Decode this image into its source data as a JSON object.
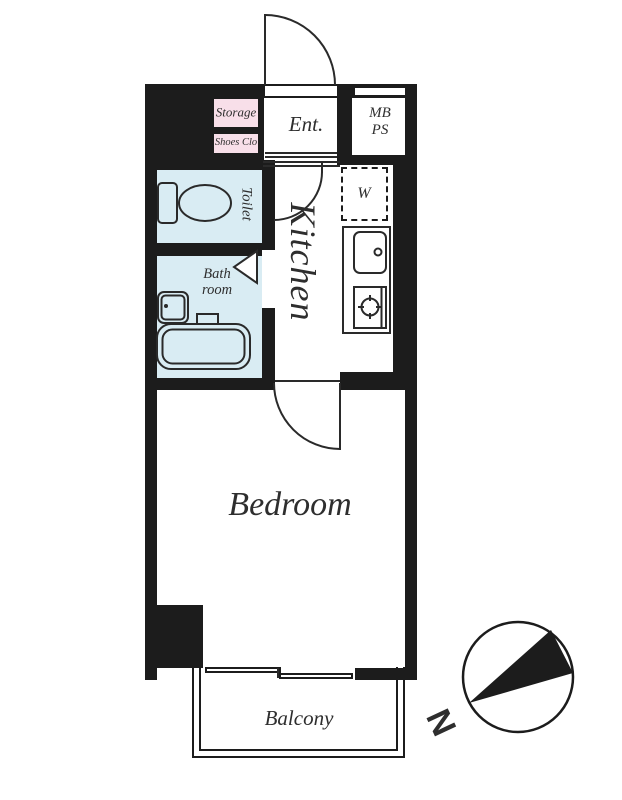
{
  "plan": {
    "type": "apartment-floor-plan",
    "labels": {
      "storage": "Storage",
      "shoes_closet": "Shoes Clo",
      "entrance": "Ent.",
      "meter_box_line1": "MB",
      "meter_box_line2": "PS",
      "toilet": "Toilet",
      "washer": "W",
      "kitchen": "Kitchen",
      "bath_line1": "Bath",
      "bath_line2": "room",
      "bedroom": "Bedroom",
      "balcony": "Balcony",
      "compass_north": "N"
    },
    "colors": {
      "wall": "#1c1c1c",
      "wet": "#d9ecf3",
      "closet": "#f8dfe9",
      "line": "#2a2a2a",
      "text": "#2e2e2e",
      "bg": "#ffffff"
    }
  }
}
